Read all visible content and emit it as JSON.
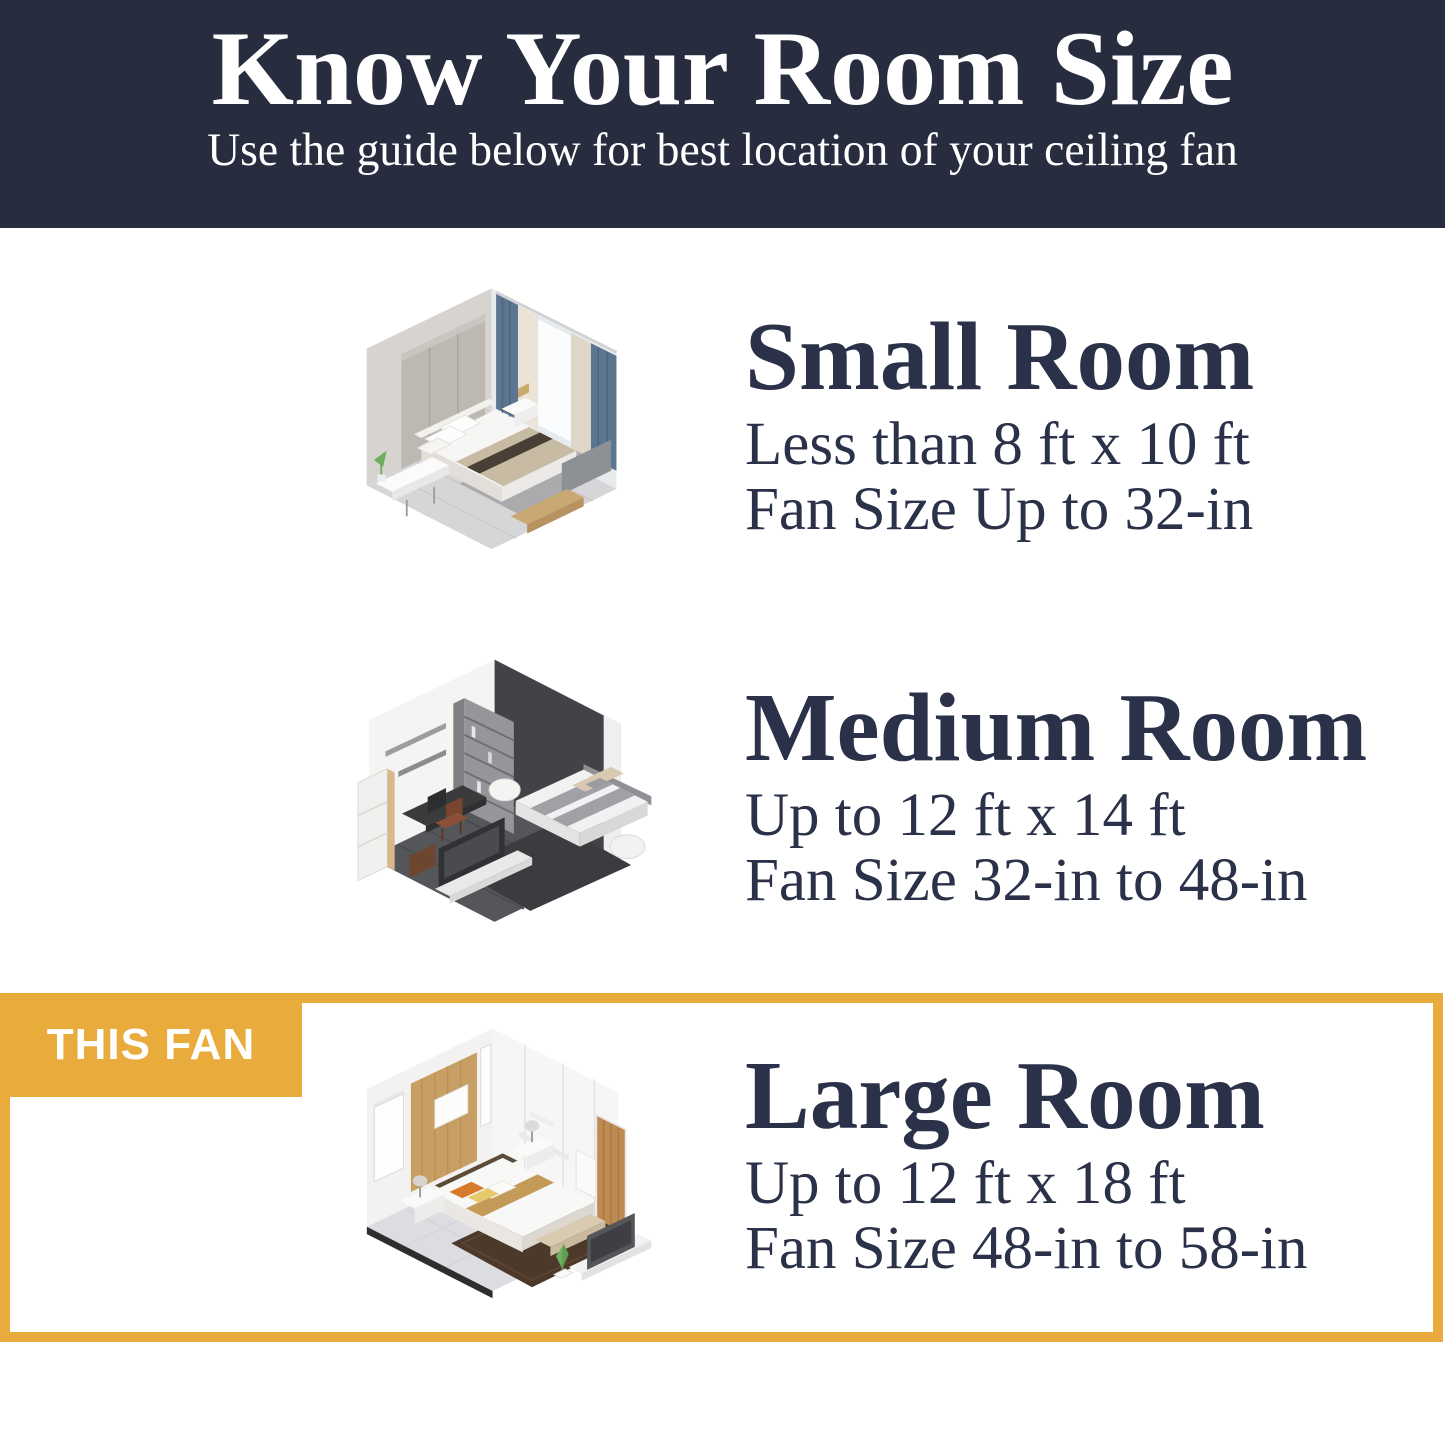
{
  "header": {
    "title": "Know Your Room Size",
    "subtitle": "Use the guide below for best location of your ceiling fan"
  },
  "sections": [
    {
      "id": "small",
      "title": "Small Room",
      "dimensions": "Less than 8 ft x 10 ft",
      "fan_size": "Fan Size Up to 32-in",
      "highlighted": false,
      "illustration": "small-room-isometric-bedroom"
    },
    {
      "id": "medium",
      "title": "Medium Room",
      "dimensions": "Up to 12 ft x 14 ft",
      "fan_size": "Fan Size 32-in to 48-in",
      "highlighted": false,
      "illustration": "medium-room-isometric-bedroom"
    },
    {
      "id": "large",
      "title": "Large Room",
      "dimensions": "Up to 12 ft x 18 ft",
      "fan_size": "Fan Size 48-in to 58-in",
      "highlighted": true,
      "highlight_badge": "THIS FAN",
      "illustration": "large-room-isometric-bedroom"
    }
  ],
  "colors": {
    "header_background": "#272C3F",
    "heading_text": "#2A3148",
    "highlight_accent": "#E9AC3C",
    "badge_text": "#FFFFFF",
    "page_background": "#FFFFFF"
  }
}
